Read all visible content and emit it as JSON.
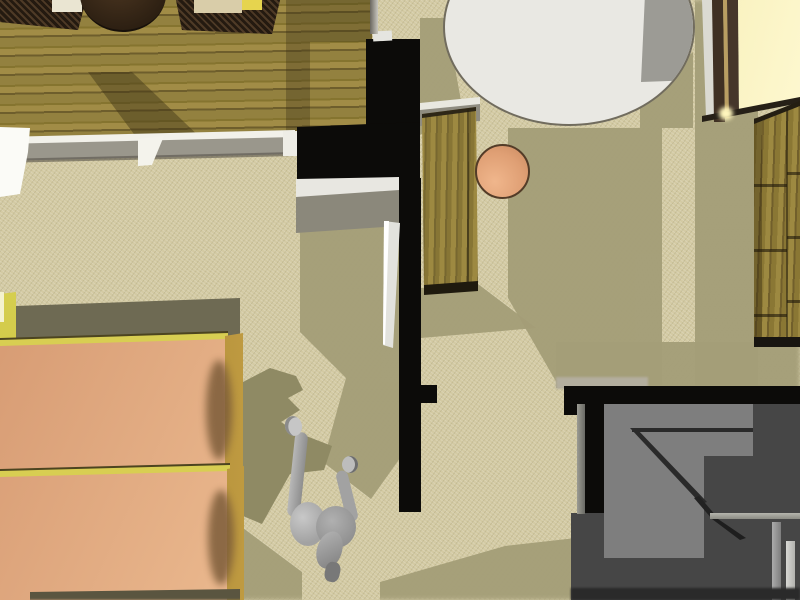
{
  "scene": {
    "title": "top-down-3d-interior-rendering",
    "view": "overhead orthographic-style render of an apartment interior",
    "visible_text": "none"
  },
  "palette": {
    "carpet_base": "#d3caa3",
    "carpet_shadow": "#a49e78",
    "carpet_shadow_dark": "#8f8a64",
    "wood_floor_mid": "#93813f",
    "black_wall": "#0c0b09",
    "parapet_white": "#f2f1ea",
    "parapet_gray": "#9a978c",
    "rug_white": "#e9e8e3",
    "rug_shadow_gray": "#9c9b95",
    "desk_wood": "#8e7c3a",
    "stool_peach": "#e2a57c",
    "stool_outline": "#533c28",
    "mattress_peach": "#e9b68c",
    "bed_frame_yellow": "#d8ce52",
    "headboard_gold": "#c19a3e",
    "shelf_olive": "#6e6a53",
    "lit_strip_yellow": "#d5cc4a",
    "figure_gray": "#a8a8a8",
    "lower_floor_dark": "#464646",
    "lower_floor_light": "#7e7e7e",
    "window_glow": "#f7eeab",
    "window_frame_brown": "#3f3023",
    "cabinet_wood": "#8f7c38",
    "gray_cabinet": "#8b887b",
    "door_white": "#e2e2dd",
    "wicker_brown": "#2f2416"
  },
  "objects": [
    {
      "name": "wood-floor-area",
      "region": "upper-left",
      "color_ref": "wood_floor_mid"
    },
    {
      "name": "wicker-chair-left",
      "region": "top edge",
      "color_ref": "wicker_brown"
    },
    {
      "name": "round-wicker-table",
      "region": "top edge",
      "color_ref": "wicker_brown"
    },
    {
      "name": "wicker-chair-right",
      "region": "top edge",
      "color_ref": "wicker_brown"
    },
    {
      "name": "parapet-half-wall",
      "region": "between wood floor and carpet",
      "color_ref": "parapet_gray"
    },
    {
      "name": "black-partition-wall",
      "region": "center, T-shaped",
      "color_ref": "black_wall"
    },
    {
      "name": "open-door-leaf",
      "region": "left of vertical wall",
      "color_ref": "door_white"
    },
    {
      "name": "wooden-desk",
      "region": "center-top",
      "color_ref": "desk_wood"
    },
    {
      "name": "round-stool",
      "region": "beside desk",
      "color_ref": "stool_peach"
    },
    {
      "name": "oval-rug",
      "region": "top-right",
      "color_ref": "rug_white"
    },
    {
      "name": "glowing-window-panel",
      "region": "top-right corner",
      "color_ref": "window_glow"
    },
    {
      "name": "tall-wooden-cabinet",
      "region": "right edge",
      "color_ref": "cabinet_wood"
    },
    {
      "name": "bed-upper",
      "region": "lower-left",
      "color_ref": "mattress_peach"
    },
    {
      "name": "bed-lower",
      "region": "lower-left",
      "color_ref": "mattress_peach"
    },
    {
      "name": "headboard-shelf-band",
      "region": "above beds",
      "color_ref": "shelf_olive"
    },
    {
      "name": "human-figure",
      "region": "bottom-center",
      "color_ref": "figure_gray"
    },
    {
      "name": "figure-cast-shadow",
      "region": "left of figure",
      "color_ref": "carpet_shadow_dark"
    },
    {
      "name": "lower-level-floor",
      "region": "bottom-right",
      "color_ref": "lower_floor_dark"
    },
    {
      "name": "lower-level-landing",
      "region": "bottom-right",
      "color_ref": "lower_floor_light"
    },
    {
      "name": "carpet-floor",
      "region": "center",
      "color_ref": "carpet_base"
    }
  ]
}
